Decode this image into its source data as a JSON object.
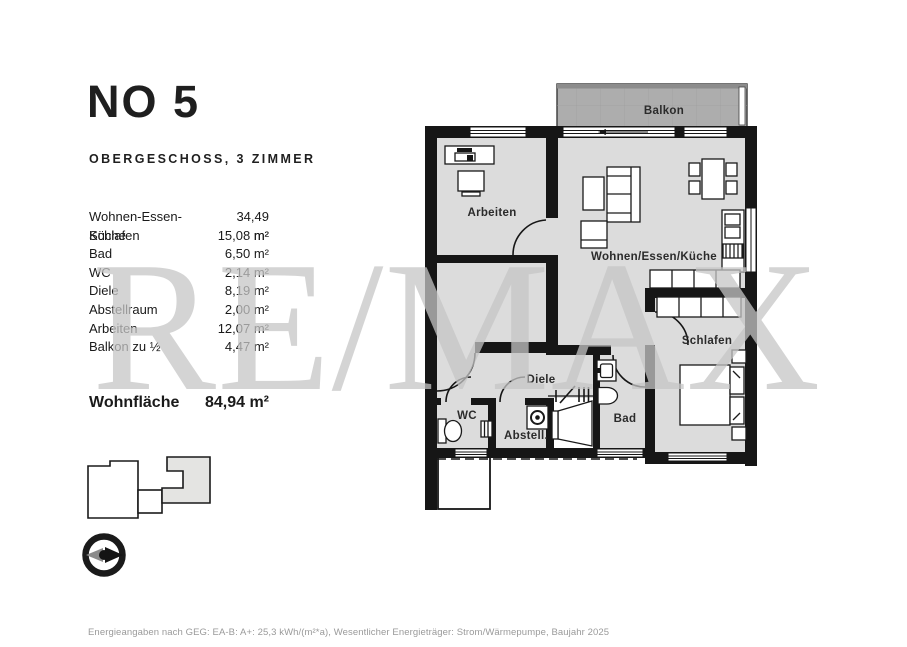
{
  "header": {
    "title": "NO 5",
    "subtitle": "OBERGESCHOSS, 3 ZIMMER"
  },
  "area_table": {
    "rows": [
      {
        "label": "Wohnen-Essen-Küche",
        "value": "34,49 m²"
      },
      {
        "label": "Schlafen",
        "value": "15,08 m²"
      },
      {
        "label": "Bad",
        "value": "6,50 m²"
      },
      {
        "label": "WC",
        "value": "2,14 m²"
      },
      {
        "label": "Diele",
        "value": "8,19 m²"
      },
      {
        "label": "Abstellraum",
        "value": "2,00 m²"
      },
      {
        "label": "Arbeiten",
        "value": "12,07 m²"
      },
      {
        "label": "Balkon zu ½",
        "value": "4,47 m²"
      }
    ],
    "total": {
      "label": "Wohnfläche",
      "value": "84,94 m²"
    }
  },
  "floorplan": {
    "labels": {
      "balkon": "Balkon",
      "arbeiten": "Arbeiten",
      "wohnen": "Wohnen/Essen/Küche",
      "schlafen": "Schlafen",
      "diele": "Diele",
      "wc": "WC",
      "abstell": "Abstell.",
      "bad": "Bad"
    }
  },
  "watermark": "RE/MAX",
  "footer": "Energieangaben nach GEG: EA-B: A+: 25,3 kWh/(m²*a), Wesentlicher Energieträger: Strom/Wärmepumpe, Baujahr 2025",
  "icons": {
    "compass": "compass-rose-icon",
    "site_plan": "building-footprint-icon"
  },
  "colors": {
    "floor": "#dcdcdc",
    "balcony": "#adadad",
    "wall": "#161616",
    "watermark": "#c6c6c6"
  }
}
